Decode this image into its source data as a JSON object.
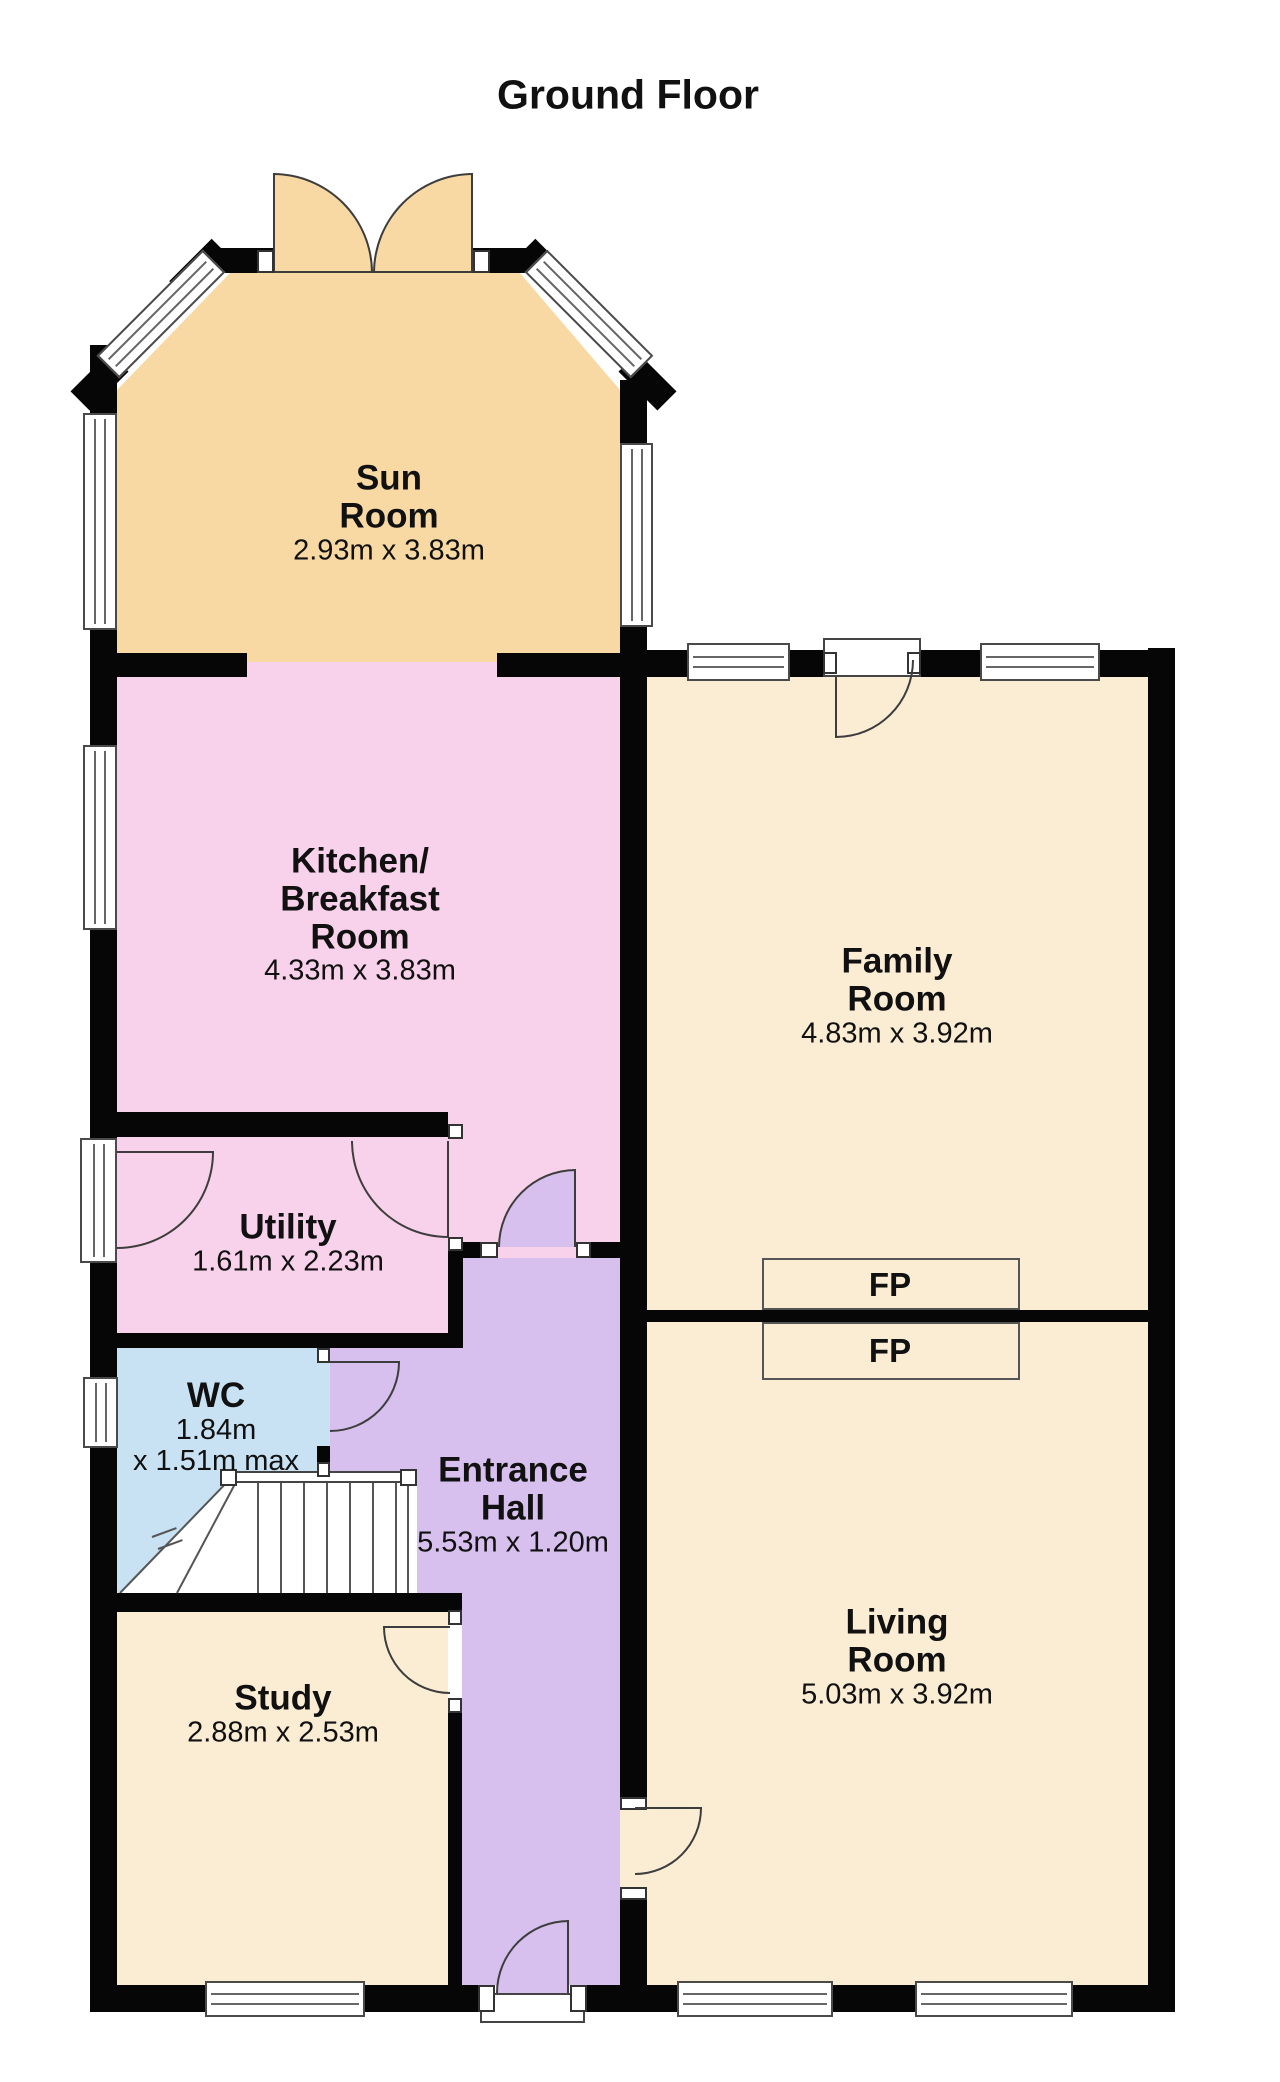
{
  "title": "Ground Floor",
  "rooms": {
    "sun": {
      "line1": "Sun",
      "line2": "Room",
      "dims": "2.93m x 3.83m"
    },
    "kitchen": {
      "line1": "Kitchen/",
      "line2": "Breakfast",
      "line3": "Room",
      "dims": "4.33m x 3.83m"
    },
    "family": {
      "line1": "Family",
      "line2": "Room",
      "dims": "4.83m x 3.92m"
    },
    "utility": {
      "line1": "Utility",
      "dims": "1.61m x 2.23m"
    },
    "wc": {
      "line1": "WC",
      "dims1": "1.84m",
      "dims2": "x 1.51m max"
    },
    "hall": {
      "line1": "Entrance",
      "line2": "Hall",
      "dims": "5.53m x 1.20m"
    },
    "study": {
      "line1": "Study",
      "dims": "2.88m x 2.53m"
    },
    "living": {
      "line1": "Living",
      "line2": "Room",
      "dims": "5.03m x 3.92m"
    },
    "fireplace_family": {
      "label": "FP"
    },
    "fireplace_living": {
      "label": "FP"
    }
  },
  "colors": {
    "sun": "#F8D9A3",
    "pink": "#F8D2EB",
    "cream": "#FAEDD4",
    "hall": "#D7BFEE",
    "wc": "#C8E2F4",
    "wall": "#060606",
    "line": "#3d3d3d",
    "text": "#111111"
  }
}
